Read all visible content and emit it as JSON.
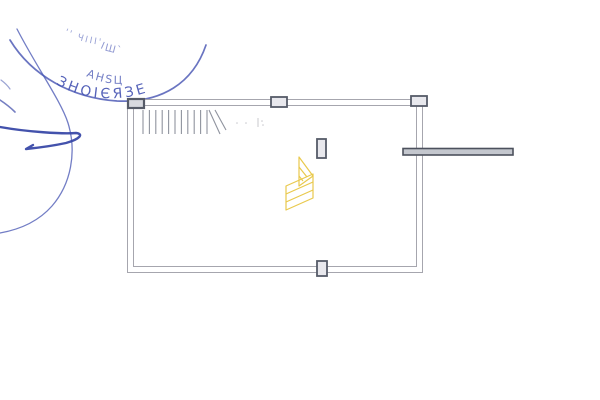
{
  "document": {
    "kind": "scanned-floor-plan-drawing",
    "background": "#ffffff"
  },
  "stamp": {
    "ink_color": "#4353b2",
    "blur": 0.35,
    "ring_arcs": [
      {
        "d": "M 10,40 C 32,76 72,98 117,101 C 162,103 193,83 206,45",
        "width": 1.7,
        "opacity": 0.8
      },
      {
        "d": "M 17,29 C 36,66 61,101 68,123 C 77,152 71,184 52,206 C 37,223 17,230 0,233",
        "width": 1.3,
        "opacity": 0.75
      }
    ],
    "arc_texts": [
      {
        "text": "ЗНОІЄЯЗЕ",
        "d": "M 56,84 C 95,107 150,103 194,66",
        "size": 14,
        "opacity": 0.9,
        "letter_spacing": 3
      },
      {
        "text": "АНЅЦ",
        "d": "M 86,76 C 112,88 138,86 160,71",
        "size": 11,
        "opacity": 0.75,
        "letter_spacing": 2
      },
      {
        "text": "ІШ`",
        "d": "M 100,48 C 118,57 140,55 156,44",
        "size": 10,
        "opacity": 0.6,
        "letter_spacing": 2
      },
      {
        "text": "'' ЧІІІ'",
        "d": "M 64,34 C 90,47 120,49 150,41",
        "size": 9,
        "opacity": 0.55,
        "letter_spacing": 2
      }
    ]
  },
  "signature": {
    "ink_color": "#3a49a8",
    "strokes": [
      {
        "d": "M 0,127 C 28,132 62,134 76,133 C 84,134 80,139 66,143 C 52,146 36,148 26,149 L 33,145",
        "width": 2.4,
        "opacity": 0.95
      },
      {
        "d": "M 0,100 C 6,104 11,108 15,112",
        "width": 1.6,
        "opacity": 0.7
      },
      {
        "d": "M 1,80 C 5,83 8,86 10,89",
        "width": 1.2,
        "opacity": 0.5
      }
    ]
  },
  "plan": {
    "wall_color": "#a6a6ae",
    "wall_width": 1,
    "outer_wall": {
      "x": 127,
      "y": 99,
      "w": 295,
      "h": 173
    },
    "inner_wall": {
      "x": 133,
      "y": 105,
      "w": 283,
      "h": 161
    },
    "stairs": {
      "color": "#8f939e",
      "line_width": 1.1,
      "y_top": 110,
      "y_bottom": 134,
      "x_start": 143,
      "step_spacing": 6.4,
      "step_count": 11,
      "break_lines": [
        "M 209,110 L 220,134",
        "M 215,110 L 226,130"
      ]
    },
    "markers": {
      "stroke": "#565b68",
      "stroke_width": 1.8,
      "fill": "#e8e8ed",
      "items": [
        {
          "x": 128,
          "y": 99,
          "w": 16,
          "h": 9,
          "label": "column-top-left",
          "fill": "#d8d9df",
          "stroke_width": 2.2
        },
        {
          "x": 271,
          "y": 97,
          "w": 16,
          "h": 10,
          "label": "column-top-middle"
        },
        {
          "x": 411,
          "y": 96,
          "w": 16,
          "h": 10,
          "label": "column-top-right"
        },
        {
          "x": 317,
          "y": 139,
          "w": 9,
          "h": 19,
          "label": "column-interior"
        },
        {
          "x": 317,
          "y": 261,
          "w": 10,
          "h": 15,
          "label": "column-bottom-middle"
        }
      ]
    },
    "beam": {
      "x": 403,
      "y": 148.5,
      "w": 110,
      "h": 6.5,
      "stroke": "#4c515d",
      "fill": "#c4c7ce",
      "stroke_width": 1.6
    },
    "pencil_marks": {
      "color": "#c8c8ce",
      "dots": [
        [
          237,
          123
        ],
        [
          246,
          123
        ],
        [
          262,
          121
        ],
        [
          263,
          125
        ]
      ],
      "ticks": [
        "M 258,118 L 258,127"
      ]
    }
  },
  "logo": {
    "color": "#e9c94d",
    "stroke_width": 1.2,
    "outline_paths": [
      "M 299,157 L 299,186 L 313,176 Z",
      "M 286,186 L 313,174 L 313,198 L 286,210 Z"
    ],
    "hatch_paths": [
      "M 299,167 L 307,177",
      "M 299,176 L 303,181",
      "M 286,194 L 313,182",
      "M 286,202 L 313,190"
    ]
  }
}
